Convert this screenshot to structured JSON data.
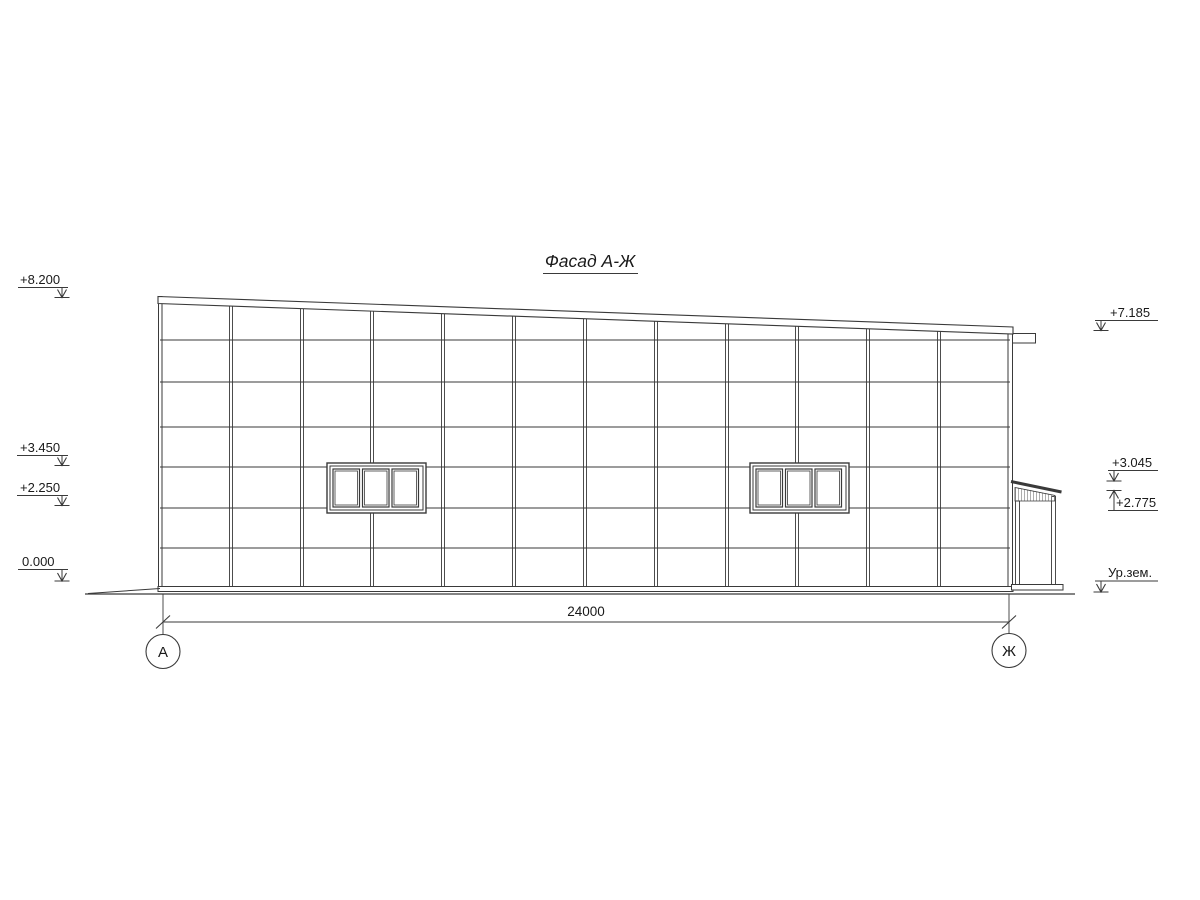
{
  "title": "Фасад А-Ж",
  "elevation_marks": {
    "left": [
      {
        "label": "+8.200"
      },
      {
        "label": "+3.450"
      },
      {
        "label": "+2.250"
      },
      {
        "label": "0.000"
      }
    ],
    "right": [
      {
        "label": "+7.185"
      },
      {
        "label": "+3.045"
      },
      {
        "label": "+2.775"
      },
      {
        "label": "Ур.зем."
      }
    ]
  },
  "dimension": {
    "total": "24000"
  },
  "axes": {
    "left": "А",
    "right": "Ж"
  },
  "facade": {
    "bays": 12,
    "panel_rows": 7,
    "windows": 2,
    "window_panes": 3
  },
  "colors": {
    "line": "#3a3a3a",
    "text": "#1a1a1a",
    "background": "#ffffff"
  }
}
